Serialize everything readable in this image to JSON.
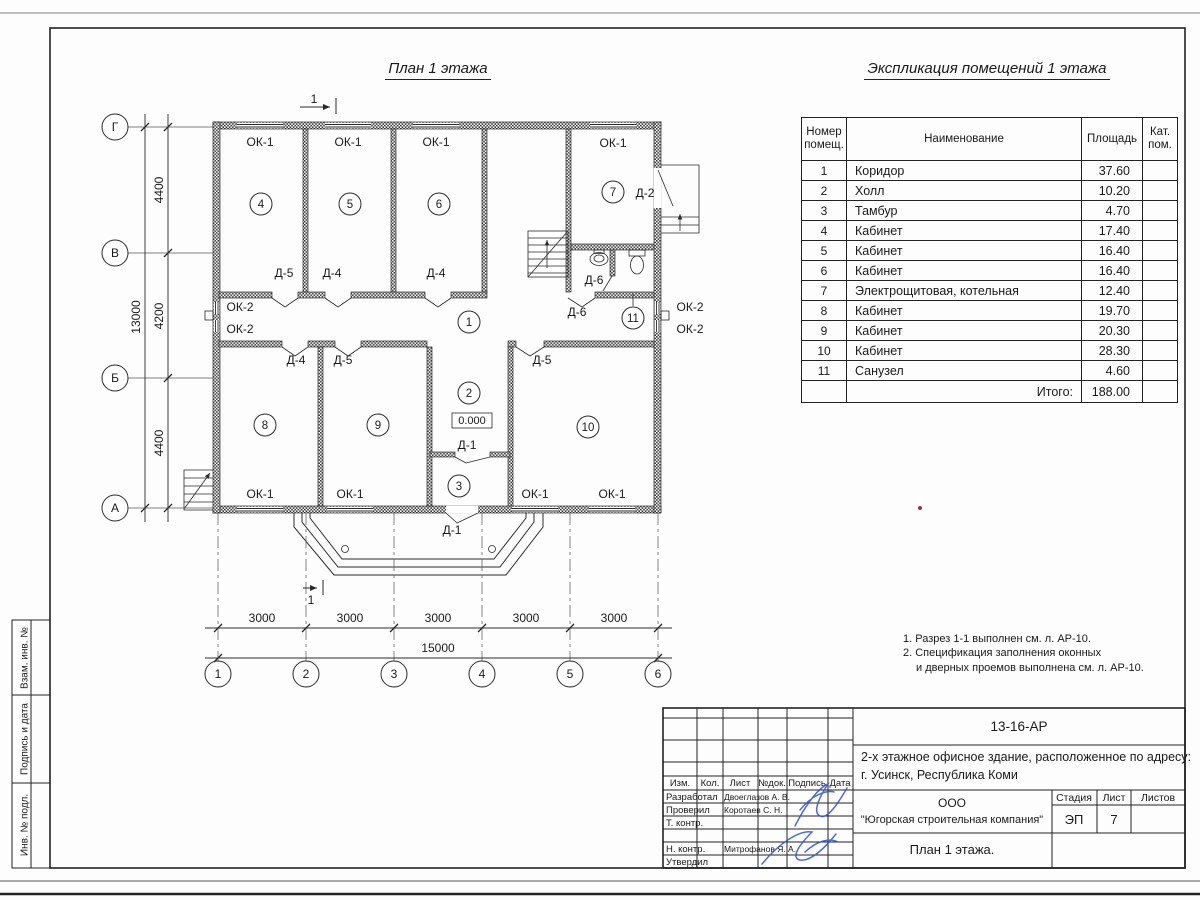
{
  "sheet": {
    "plan_title": "План 1 этажа",
    "table_title": "Экспликация помещений 1 этажа",
    "notes": {
      "line1": "1. Разрез 1-1 выполнен см. л. АР-10.",
      "line2": "2. Спецификация заполнения оконных",
      "line3": "и дверных проемов выполнена см. л. АР-10."
    }
  },
  "plan": {
    "grid_cols": [
      "1",
      "2",
      "3",
      "4",
      "5",
      "6"
    ],
    "grid_rows": [
      "Г",
      "В",
      "Б",
      "А"
    ],
    "dims": {
      "bay": "3000",
      "total_width": "15000",
      "h_top": "4400",
      "h_mid": "4200",
      "h_bottom": "4400",
      "total_height": "13000"
    },
    "rooms": {
      "r1": "1",
      "r2": "2",
      "r3": "3",
      "r4": "4",
      "r5": "5",
      "r6": "6",
      "r7": "7",
      "r8": "8",
      "r9": "9",
      "r10": "10",
      "r11": "11"
    },
    "labels": {
      "ok1": "ОК-1",
      "ok2": "ОК-2",
      "d1": "Д-1",
      "d2": "Д-2",
      "d4": "Д-4",
      "d5": "Д-5",
      "d6": "Д-6"
    },
    "elevation": "0.000",
    "section_mark": "1"
  },
  "schedule": {
    "headers": {
      "num": "Номер помещ.",
      "name": "Наименование",
      "area": "Площадь",
      "cat": "Кат. пом."
    },
    "rows": [
      {
        "num": "1",
        "name": "Коридор",
        "area": "37.60"
      },
      {
        "num": "2",
        "name": "Холл",
        "area": "10.20"
      },
      {
        "num": "3",
        "name": "Тамбур",
        "area": "4.70"
      },
      {
        "num": "4",
        "name": "Кабинет",
        "area": "17.40"
      },
      {
        "num": "5",
        "name": "Кабинет",
        "area": "16.40"
      },
      {
        "num": "6",
        "name": "Кабинет",
        "area": "16.40"
      },
      {
        "num": "7",
        "name": "Электрощитовая, котельная",
        "area": "12.40"
      },
      {
        "num": "8",
        "name": "Кабинет",
        "area": "19.70"
      },
      {
        "num": "9",
        "name": "Кабинет",
        "area": "20.30"
      },
      {
        "num": "10",
        "name": "Кабинет",
        "area": "28.30"
      },
      {
        "num": "11",
        "name": "Санузел",
        "area": "4.60"
      }
    ],
    "total_label": "Итого:",
    "total_area": "188.00"
  },
  "titleblock": {
    "doc_number": "13-16-АР",
    "description1": "2-х этажное офисное здание, расположенное по адресу:",
    "description2": "г. Усинск, Республика Коми",
    "company1": "ООО",
    "company2": "\"Югорская строительная компания\"",
    "drawing_title": "План 1 этажа.",
    "stage_label": "Стадия",
    "sheet_label": "Лист",
    "sheets_label": "Листов",
    "stage": "ЭП",
    "sheet_number": "7",
    "header_cols": [
      "Изм.",
      "Кол.",
      "Лист",
      "№док.",
      "Подпись",
      "Дата"
    ],
    "rows": [
      {
        "role": "Разработал",
        "name": "Двоеглазов А. В."
      },
      {
        "role": "Проверил",
        "name": "Коротаев С. Н."
      },
      {
        "role": "Т. контр.",
        "name": ""
      },
      {
        "role": "Н. контр.",
        "name": "Митрофанов Я. А."
      },
      {
        "role": "Утвердил",
        "name": ""
      }
    ]
  },
  "sidebar": {
    "box1": "Взам. инв. №",
    "box2": "Подпись и дата",
    "box3": "Инв. № подл."
  }
}
